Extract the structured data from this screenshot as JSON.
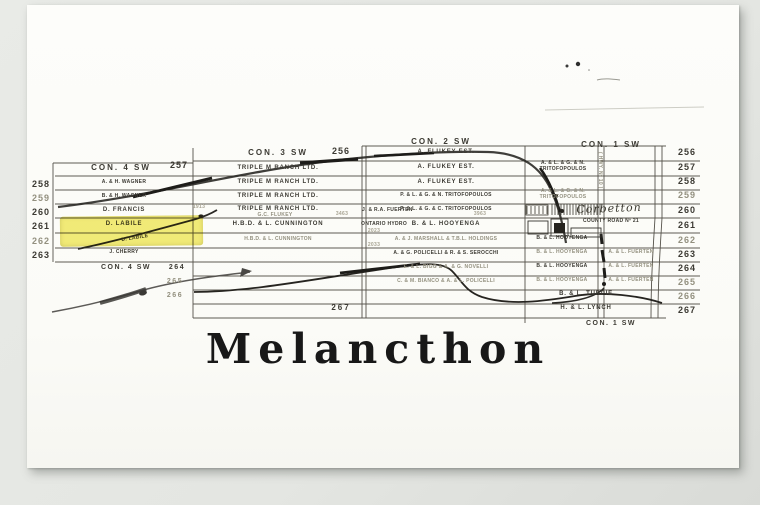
{
  "title": "Melancthon",
  "headers": {
    "con4_top": "CON. 4 SW",
    "con4_top_num": "257",
    "con3_top": "CON. 3 SW",
    "con3_top_num": "256",
    "con2_top": "CON. 2 SW",
    "con1_top": "CON. 1 SW",
    "con4_bottom": "CON. 4 SW",
    "con1_bottom": "CON. 1 SW"
  },
  "row_numbers": {
    "left": [
      "258",
      "259",
      "260",
      "261",
      "262",
      "263"
    ],
    "right": [
      "256",
      "257",
      "258",
      "259",
      "260",
      "261",
      "262",
      "263",
      "264",
      "265",
      "266",
      "267"
    ],
    "center": [
      "264",
      "265",
      "266",
      "267"
    ]
  },
  "lots": {
    "con4": {
      "r258": "A. & H. WAGNER",
      "r259": "B. & H. WAGNER",
      "r260": "D. FRANCIS",
      "r261": "D. LABILE",
      "r262": "D. LABILE",
      "r263": "J. CHERRY"
    },
    "con3": {
      "r257": "TRIPLE M RANCH LTD.",
      "r258": "TRIPLE M RANCH LTD.",
      "r259": "TRIPLE M RANCH LTD.",
      "r260": "TRIPLE M RANCH LTD.",
      "r260b": "G.C. FLUKEY",
      "r261": "H.B.D. & L. CUNNINGTON",
      "r262": "H.B.D. & L. CUNNINGTON"
    },
    "con2": {
      "r256": "A. FLUKEY EST.",
      "r257": "A. FLUKEY EST.",
      "r258": "A. FLUKEY EST.",
      "r259": "P. & L. & G. & N. TRITOFOPOULOS",
      "r260": "P. & L. & G. & C. TRITOFOPOULOS",
      "r261": "B. & L. HOOYENGA",
      "r262": "A. & J. MARSHALL & T.B.L. HOLDINGS",
      "r263": "A. & G. POLICELLI & R. & S. SEROCCHI",
      "r264": "E. & L. BIGG & A. & G. NOVELLI",
      "r265": "C. & M. BIANCO & A. & L. POLICELLI",
      "small_fuerten": "J. & R.A. FUERTEN",
      "small_hydro": "ONTARIO HYDRO"
    },
    "con1": {
      "r257a": "A. & L. & G. & N.",
      "r257b": "TRITOFOPOULOS",
      "r259a": "A. & L. & G. & N.",
      "r259b": "TRITOFOPOULOS",
      "r262": "B. & L. HOOYENGA",
      "r263": "B. & L. HOOYENGA",
      "r263b": "A. & L. FUERTEN",
      "r264": "B. & L. HOOYENGA",
      "r264b": "A. & L. FUERTEN",
      "r265": "B. & L. HOOYENGA",
      "r265b": "A. & L. FUERTEN",
      "r266": "B. & L. TURPIE",
      "r267": "H. & L. LYNCH"
    }
  },
  "annotations": {
    "village": "Corbetton",
    "county_road": "COUNTY ROAD Nº 21",
    "highway": "( HWY. Nº 10 )"
  },
  "survey_marks": [
    "1913",
    "3463",
    "2023",
    "2033",
    "3963"
  ],
  "highlight_color": "#efe434"
}
